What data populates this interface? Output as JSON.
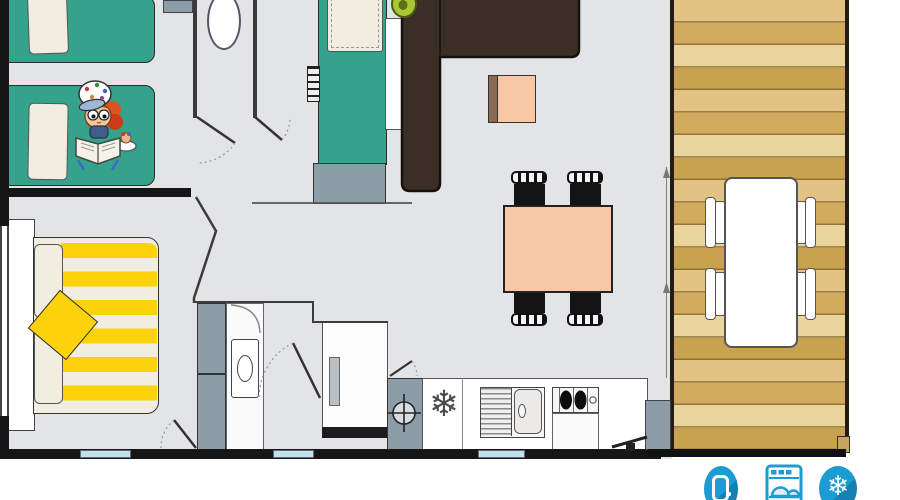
{
  "app": {
    "type": "floor-plan",
    "description": "Mobile home floor plan: two bedrooms, bathroom, kitchen and living area, wooden deck with outdoor dining set"
  },
  "colors": {
    "white": "#ffffff",
    "floor": "#e3e4e6",
    "wall": "#161616",
    "wall-gray": "#3a3a3a",
    "teal": "#35a28c",
    "cream": "#f1eee1",
    "yellow": "#fcd20b",
    "peach": "#f8c7a5",
    "sofa": "#3b2e26",
    "gray": "#8d9da8",
    "wood-a": "#e2c383",
    "wood-b": "#d2ab5e",
    "wood-c": "#e9d49c",
    "wood-d": "#c9a24f",
    "window": "#bfe2ed",
    "icon-blue": "#1d9bd3",
    "icon-blue-dark": "#1481b2",
    "lime": "#a9c934",
    "cubicle": "#fafafa"
  },
  "glyphs": {
    "kitchen_freezer": "❄",
    "ac": "❄"
  },
  "amenities": {
    "items": [
      {
        "name": "fridge-icon",
        "label": "Fridge"
      },
      {
        "name": "dishwasher-icon",
        "label": "Dishwasher"
      },
      {
        "name": "air-conditioning-icon",
        "label": "Air conditioning"
      }
    ]
  },
  "rooms": {
    "kids_bedroom": {
      "furniture": [
        "single-bed",
        "single-bed",
        "reading-child-illustration"
      ]
    },
    "master_bedroom": {
      "furniture": [
        "headboard",
        "double-bed-yellow-striped",
        "yellow-cushion",
        "wardrobe"
      ]
    },
    "bathroom": {
      "furniture": [
        "washbasin",
        "toilet",
        "shower",
        "water-heater"
      ]
    },
    "living_area": {
      "furniture": [
        "bunk-bed",
        "ladder",
        "corner-sofa",
        "plant",
        "side-table",
        "dining-table",
        "dining-chairs-x4"
      ]
    },
    "kitchen": {
      "furniture": [
        "freezer",
        "sink-with-drainer",
        "hob-2-burners",
        "cabinet"
      ]
    },
    "deck": {
      "furniture": [
        "outdoor-table",
        "outdoor-chairs-x4"
      ]
    }
  }
}
